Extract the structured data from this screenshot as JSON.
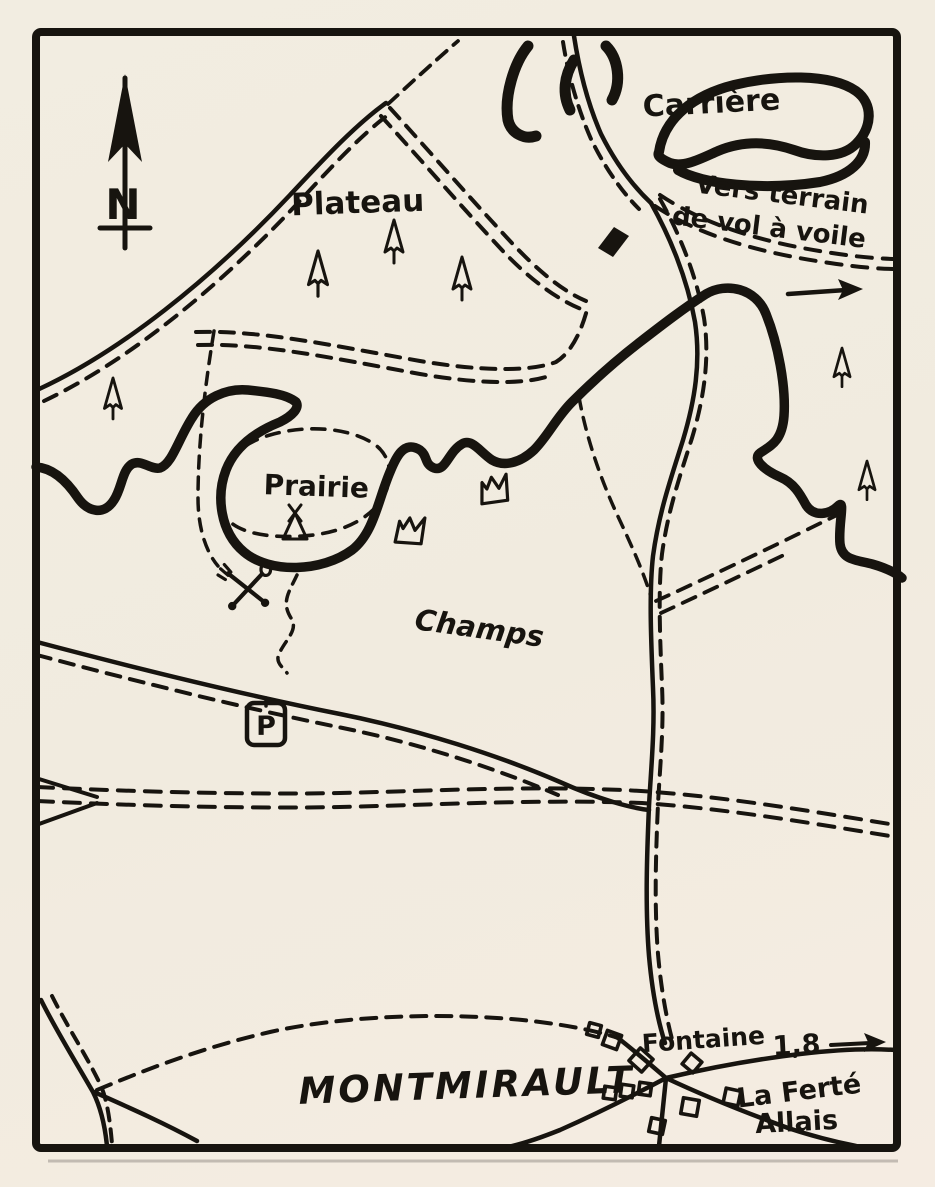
{
  "canvas": {
    "width": 935,
    "height": 1187
  },
  "colors": {
    "paper": "#f2ede1",
    "ink": "#17140f"
  },
  "compass": {
    "north_letter": "N"
  },
  "labels": {
    "carriere": "Carrière",
    "direction_line1": "Vers terrain",
    "direction_line2": "de vol à voile",
    "plateau": "Plateau",
    "prairie": "Prairie",
    "champs": "Champs",
    "village": "MONTMIRAULT",
    "fontaine": "Fontaine",
    "distance_km": "1,8",
    "ferte_line1": "La Ferté",
    "ferte_line2": "Allais",
    "parking": "P"
  },
  "symbols": {
    "north_arrow": "north-arrow",
    "conifer_tree_count": 6,
    "tent": "tent-symbol",
    "crossed_cutlery": "crossed-fork-spoon-symbol",
    "spring_symbol_count": 2,
    "parking_sign": "parking-sign",
    "village_building_count": 11,
    "direction_arrow_count": 2,
    "quarry_outline": "quarry-outline",
    "escarpment_line": "thick-escarpment-line"
  }
}
